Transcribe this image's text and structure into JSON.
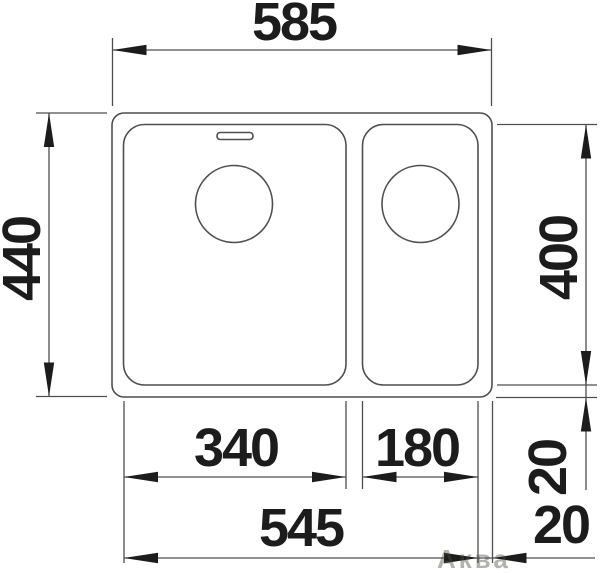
{
  "diagram": {
    "dimensions": {
      "overall_width": "585",
      "overall_depth": "440",
      "bowl_inner_depth": "400",
      "main_bowl_width": "340",
      "side_bowl_width": "180",
      "bowls_overall_width": "545",
      "rim_offset_bottom": "20",
      "rim_offset_right": "20"
    },
    "watermark": "Аква",
    "colors": {
      "line": "#4f4f4f",
      "ink": "#1c1c1c",
      "background": "#ffffff"
    }
  }
}
